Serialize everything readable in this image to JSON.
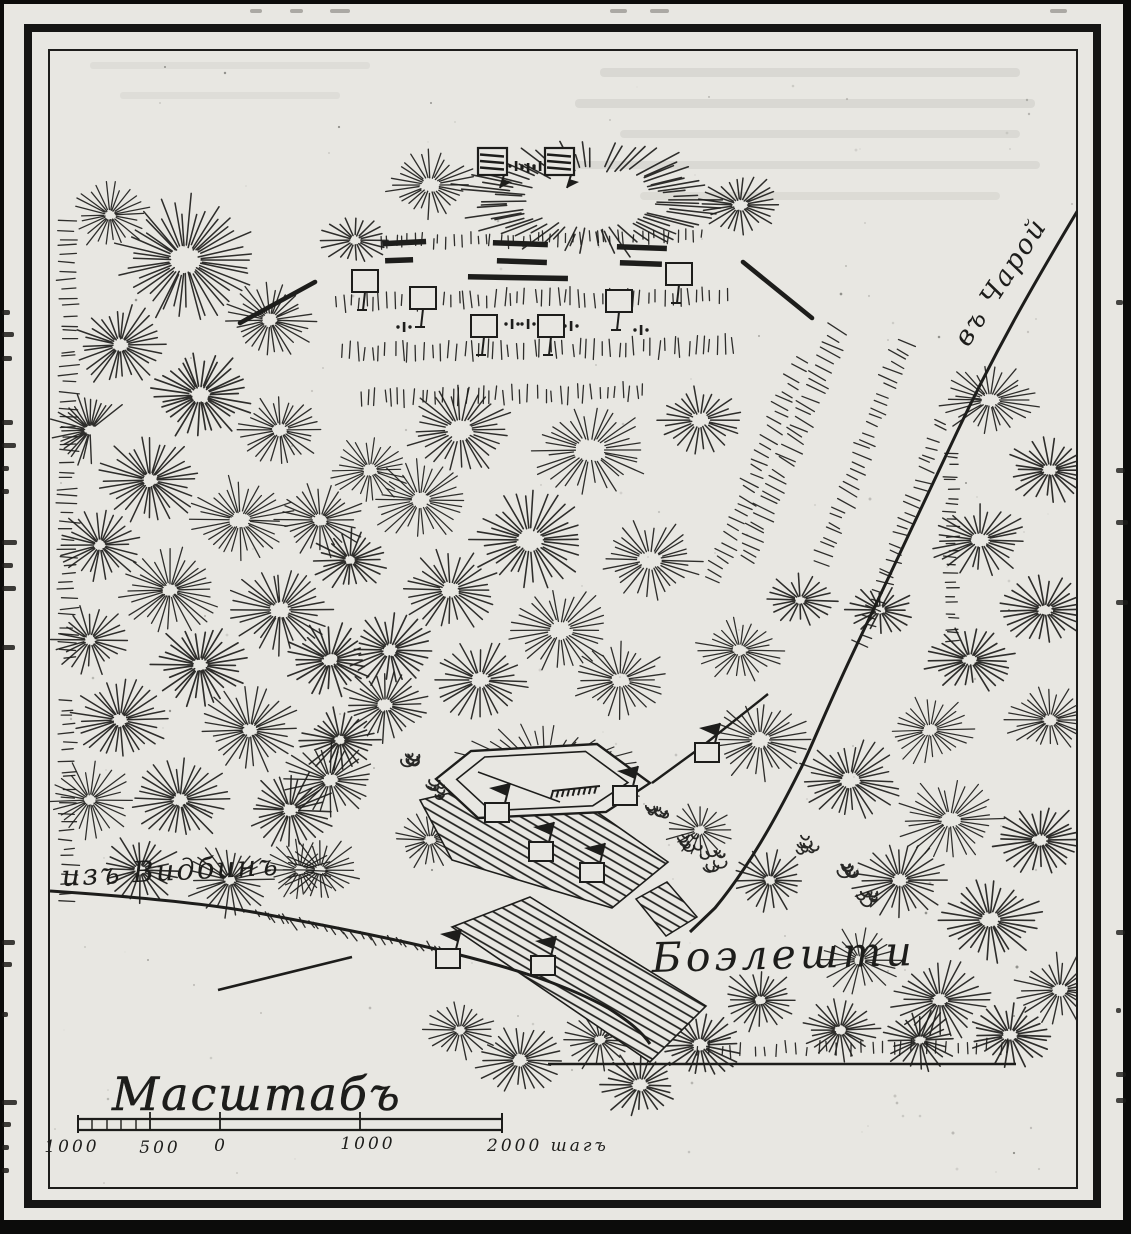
{
  "map": {
    "labels": {
      "road_to_charoy": "въ Чарой",
      "road_from_vidbin": "изъ Видбинъ",
      "village": "Боэлешти",
      "scale_title": "Масштабъ"
    },
    "scale_bar": {
      "tick_labels": [
        "1000",
        "500",
        "0",
        "1000",
        "2000 шагъ"
      ]
    },
    "colors": {
      "paper": "#e8e7e2",
      "ink": "#1d1d1b"
    },
    "symbols": [
      {
        "name": "hexagonal-redoubt",
        "count": 1
      },
      {
        "name": "hatched-camp-area",
        "count": 3
      },
      {
        "name": "flag-unit-marker",
        "count": 7
      },
      {
        "name": "turkish-tent-square",
        "count": 2
      },
      {
        "name": "infantry-line-bar",
        "count": 7
      },
      {
        "name": "battalion-square",
        "count": 6
      },
      {
        "name": "artillery-mark",
        "count": 8
      },
      {
        "name": "cavalry-flank-stroke",
        "count": 2
      },
      {
        "name": "tree-cluster",
        "count": 8
      },
      {
        "name": "road",
        "count": 3
      }
    ]
  }
}
